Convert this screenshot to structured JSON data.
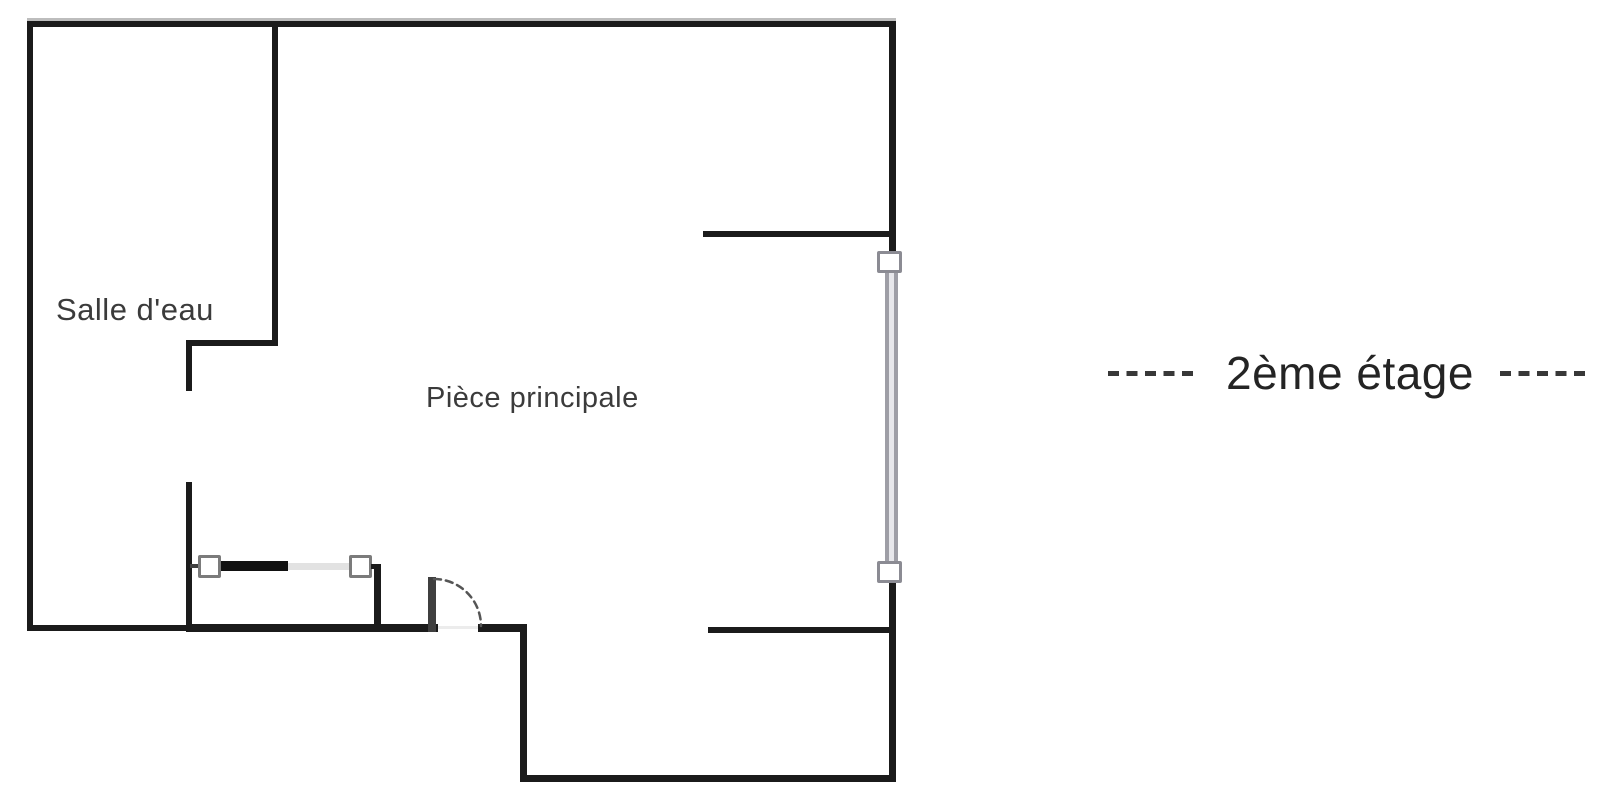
{
  "plan": {
    "title": "floor-plan",
    "rooms": [
      {
        "label": "Salle d'eau"
      },
      {
        "label": "Pièce principale"
      }
    ],
    "floor_label": "2ème étage",
    "features": [
      "window-double-line-right-wall",
      "sliding-door-closet",
      "hinged-door-swing-arc",
      "entrance-bay-bottom"
    ]
  },
  "colors": {
    "wall": "#1b1b1b",
    "wall_shadow": "#bdbdbd",
    "text": "#3b3b3b",
    "floor_text": "#242424",
    "dash": "#383838",
    "window_frame": "#9e9ea6",
    "window_fill": "#e7e7eb",
    "window_cap_border": "#8b8b93",
    "slider_square_border": "#7b7b7b",
    "sliding_bar_dark": "#111111",
    "sliding_bar_light": "#e2e2e2",
    "door_jamb": "#3f3f3f",
    "door_gap": "#ececec",
    "door_arc": "#555555"
  }
}
